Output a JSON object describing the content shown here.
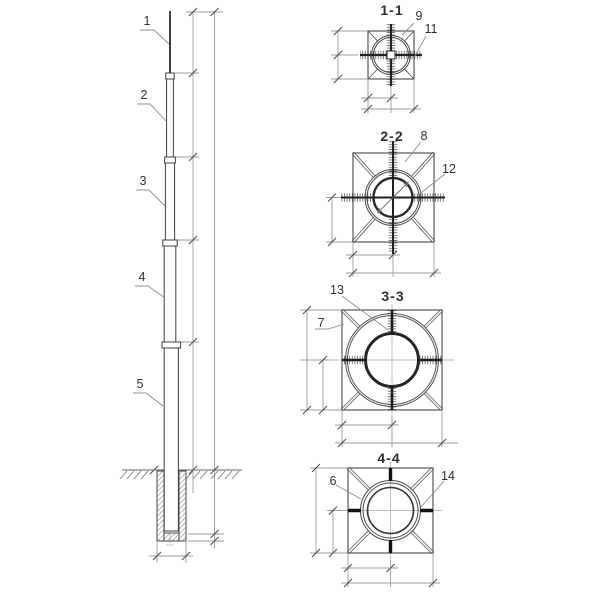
{
  "drawing_title": "telescopic-mast-elevation-and-sections",
  "colors": {
    "background": "#ffffff",
    "main_line": "#474747",
    "thick_line": "#1c1c1c",
    "dimension_line": "#9b9b9b",
    "tick": "#4f4f4f",
    "leader": "#8c8c8c",
    "text": "#2f2f2f",
    "hatch": "#7a7a7a"
  },
  "pole_view": {
    "callout_labels": [
      "1",
      "2",
      "3",
      "4",
      "5"
    ]
  },
  "sections": [
    {
      "title": "1-1",
      "callout_labels": [
        "9",
        "11"
      ]
    },
    {
      "title": "2-2",
      "callout_labels": [
        "8",
        "12"
      ]
    },
    {
      "title": "3-3",
      "callout_labels": [
        "13",
        "7"
      ]
    },
    {
      "title": "4-4",
      "callout_labels": [
        "6",
        "14"
      ]
    }
  ]
}
